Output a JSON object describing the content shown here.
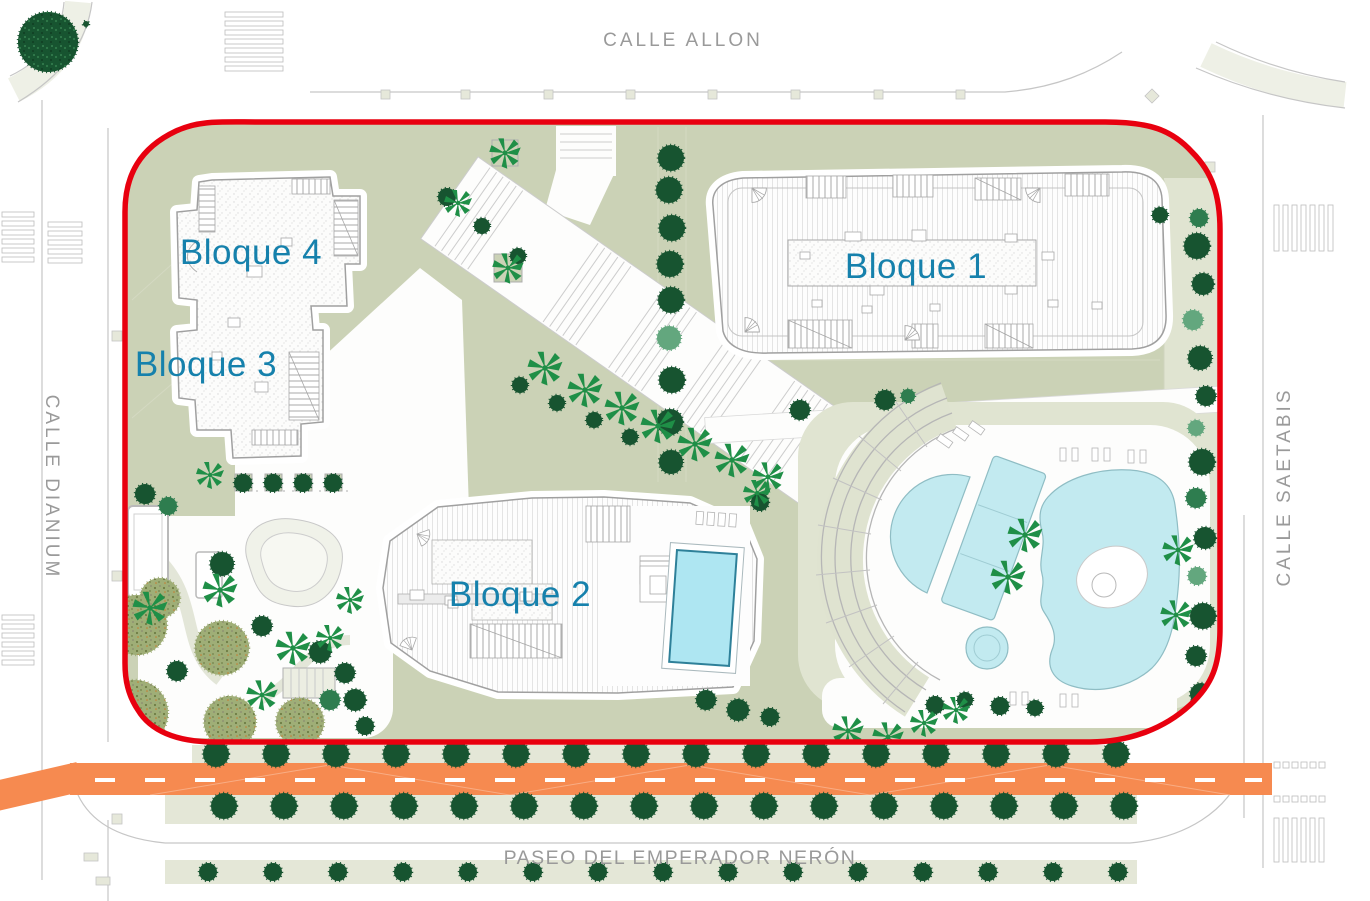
{
  "plan": {
    "streets": {
      "top": "CALLE ALLON",
      "left": "CALLE DIANIUM",
      "right": "CALLE SAETABIS",
      "bottom": "PASEO DEL EMPERADOR NERÓN"
    },
    "blocks": [
      {
        "label": "Bloque 1"
      },
      {
        "label": "Bloque 2"
      },
      {
        "label": "Bloque 3"
      },
      {
        "label": "Bloque 4"
      }
    ],
    "colors": {
      "boundary": "#e8000f",
      "label_blue": "#1681ac",
      "street_text": "#9a9a9a",
      "lawn": "#cbd2b6",
      "lawn_pale": "#e0e4d1",
      "pool": "#c2eaf0",
      "pool_rooftop": "#aee6f2",
      "road_orange": "#f68a50",
      "tree_dark": "#175430",
      "tree_medium": "#2e7d4f",
      "tree_light": "#63a77e",
      "palm_green": "#1f8f47",
      "bush_olive": "#9fae77"
    }
  }
}
